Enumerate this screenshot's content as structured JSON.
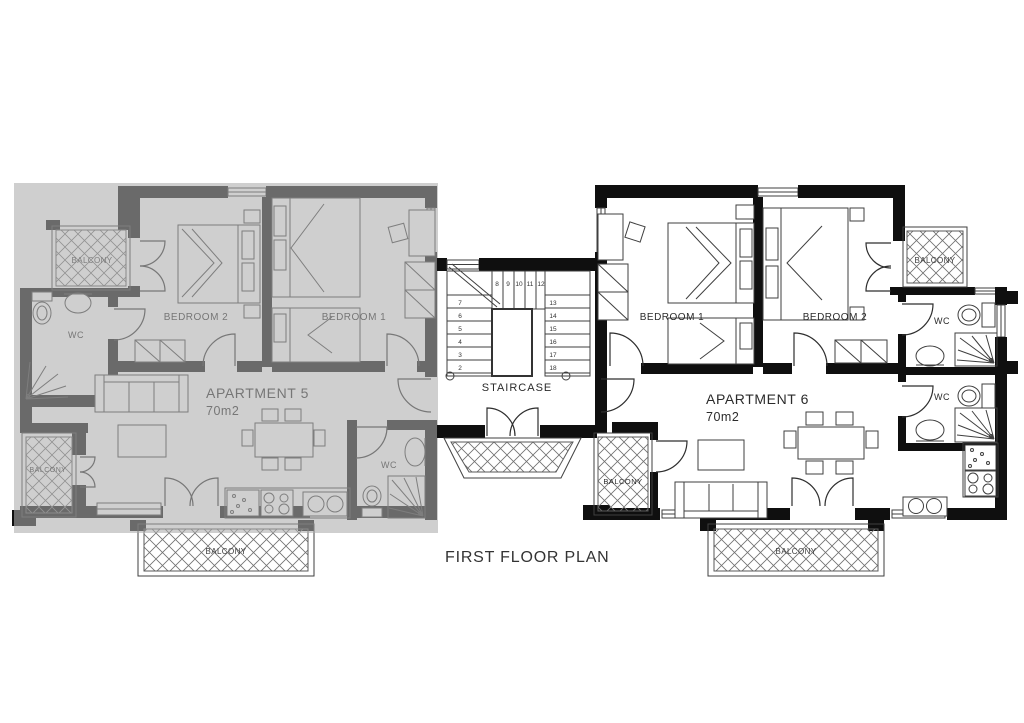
{
  "title": "FIRST FLOOR PLAN",
  "apartment5": {
    "name": "APARTMENT 5",
    "area": "70m2",
    "bedroom1_label": "BEDROOM 1",
    "bedroom2_label": "BEDROOM 2",
    "wc_top_label": "WC",
    "wc_bottom_label": "WC",
    "balcony_top_label": "BALCONY",
    "balcony_side_label": "BALCONY",
    "balcony_bottom_label": "BALCONY",
    "dimmed": true
  },
  "apartment6": {
    "name": "APARTMENT 6",
    "area": "70m2",
    "bedroom1_label": "BEDROOM 1",
    "bedroom2_label": "BEDROOM 2",
    "wc_upper_label": "WC",
    "wc_lower_label": "WC",
    "balcony_top_label": "BALCONY",
    "balcony_side_label": "BALCONY",
    "balcony_bottom_label": "BALCONY"
  },
  "staircase": {
    "label": "STAIRCASE",
    "steps_left": [
      "7",
      "6",
      "5",
      "4",
      "3",
      "2"
    ],
    "steps_top": [
      "8",
      "9",
      "10",
      "11",
      "12"
    ],
    "steps_right": [
      "13",
      "14",
      "15",
      "16",
      "17",
      "18"
    ]
  },
  "colors": {
    "wall": "#0f0f0f",
    "line": "#3f3f3f",
    "hatch": "#707070",
    "overlay": "rgba(172,172,172,0.58)",
    "text": "#2b2b2b"
  }
}
